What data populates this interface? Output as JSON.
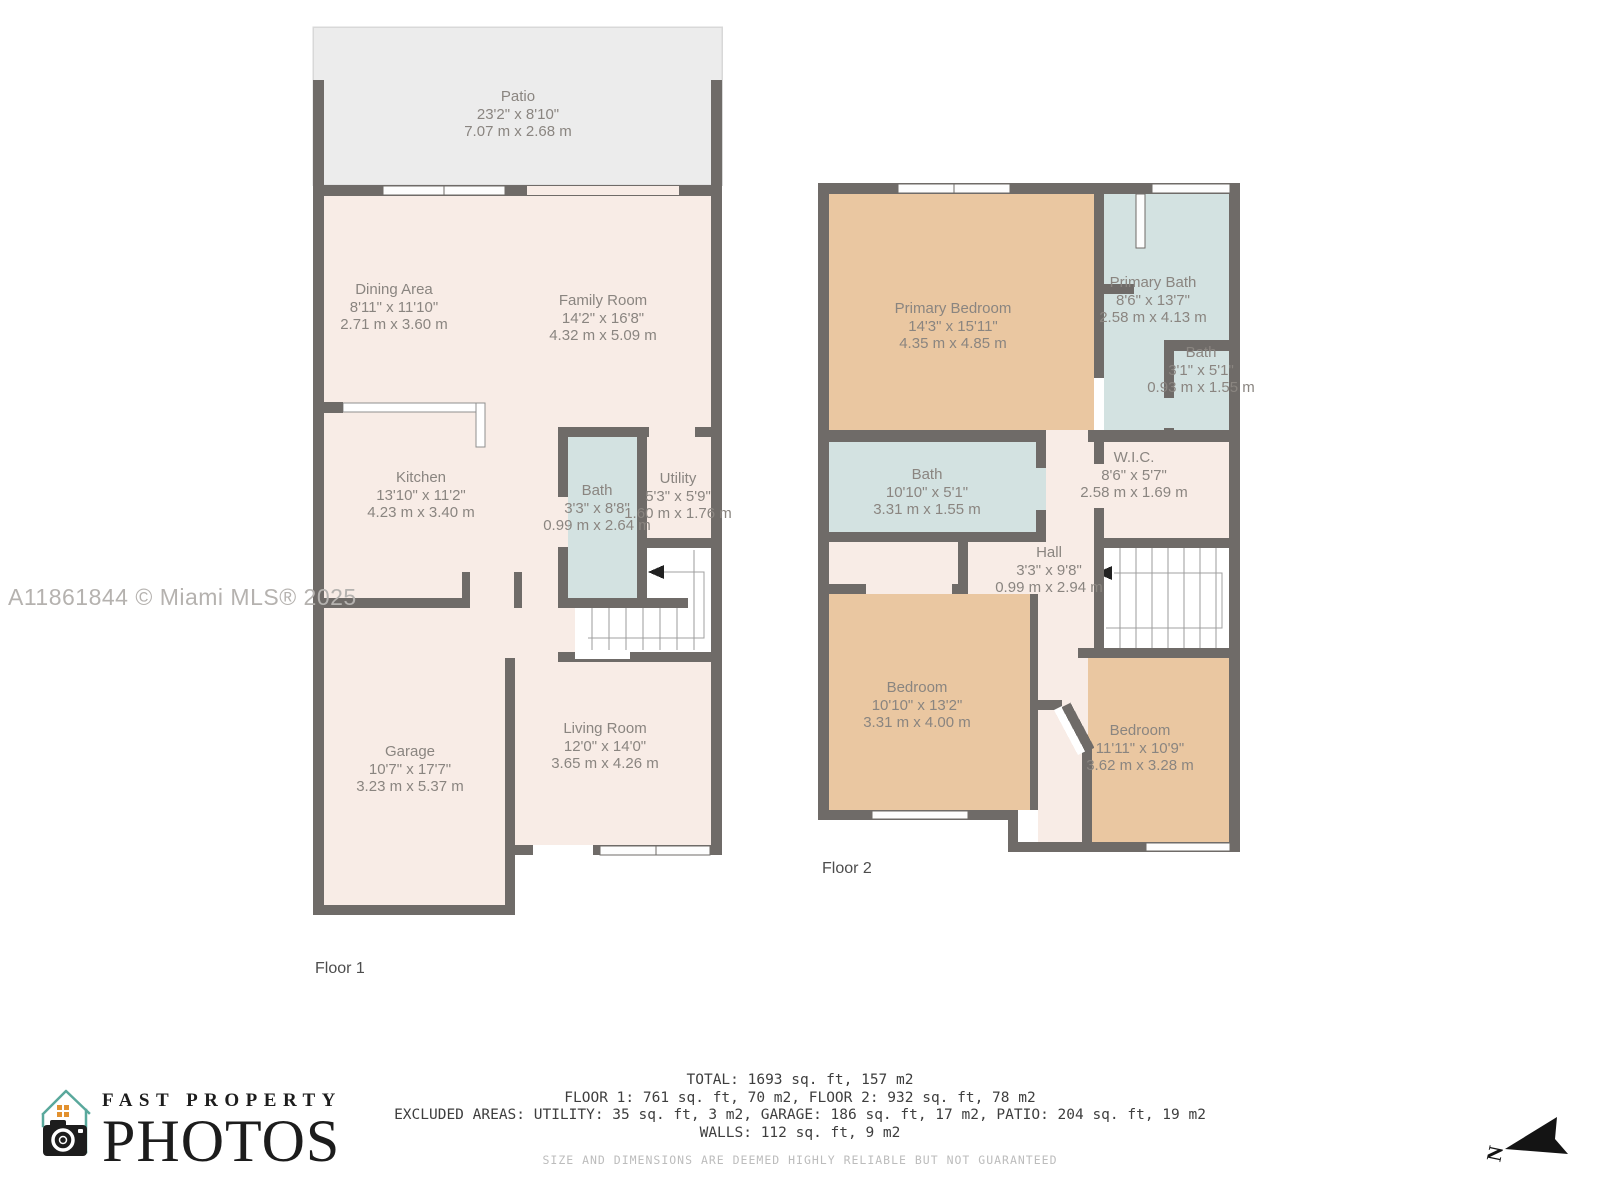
{
  "watermark": "A11861844 © Miami MLS® 2025",
  "palette": {
    "wall": "#6f6b68",
    "room_fill": "#f8ece6",
    "bedroom_fill": "#eac7a1",
    "bath_fill": "#d3e2e1",
    "patio_fill": "#ececec",
    "label_text": "#8a8580",
    "footer_text": "#3e3e3e",
    "logo_teal": "#59a89c",
    "logo_orange": "#e2912f"
  },
  "floor1": {
    "label": "Floor 1",
    "rooms": [
      {
        "name": "Patio",
        "imperial": "23'2\" x 8'10\"",
        "metric": "7.07 m x 2.68 m"
      },
      {
        "name": "Dining Area",
        "imperial": "8'11\" x 11'10\"",
        "metric": "2.71 m x 3.60 m"
      },
      {
        "name": "Family Room",
        "imperial": "14'2\" x 16'8\"",
        "metric": "4.32 m x 5.09 m"
      },
      {
        "name": "Kitchen",
        "imperial": "13'10\" x 11'2\"",
        "metric": "4.23 m x 3.40 m"
      },
      {
        "name": "Bath",
        "imperial": "3'3\" x 8'8\"",
        "metric": "0.99 m x 2.64 m"
      },
      {
        "name": "Utility",
        "imperial": "5'3\" x 5'9\"",
        "metric": "1.60 m x 1.76 m"
      },
      {
        "name": "Garage",
        "imperial": "10'7\" x 17'7\"",
        "metric": "3.23 m x 5.37 m"
      },
      {
        "name": "Living Room",
        "imperial": "12'0\" x 14'0\"",
        "metric": "3.65 m x 4.26 m"
      }
    ]
  },
  "floor2": {
    "label": "Floor 2",
    "rooms": [
      {
        "name": "Primary Bedroom",
        "imperial": "14'3\" x 15'11\"",
        "metric": "4.35 m x 4.85 m"
      },
      {
        "name": "Primary Bath",
        "imperial": "8'6\" x 13'7\"",
        "metric": "2.58 m x 4.13 m"
      },
      {
        "name": "Bath",
        "imperial": "3'1\" x 5'1\"",
        "metric": "0.93 m x 1.55 m"
      },
      {
        "name": "Bath",
        "imperial": "10'10\" x 5'1\"",
        "metric": "3.31 m x 1.55 m"
      },
      {
        "name": "W.I.C.",
        "imperial": "8'6\" x 5'7\"",
        "metric": "2.58 m x 1.69 m"
      },
      {
        "name": "Hall",
        "imperial": "3'3\" x 9'8\"",
        "metric": "0.99 m x 2.94 m"
      },
      {
        "name": "Bedroom",
        "imperial": "10'10\" x 13'2\"",
        "metric": "3.31 m x 4.00 m"
      },
      {
        "name": "Bedroom",
        "imperial": "11'11\" x 10'9\"",
        "metric": "3.62 m x 3.28 m"
      }
    ]
  },
  "footer": {
    "total": "TOTAL: 1693 sq. ft, 157 m2",
    "floors": "FLOOR 1: 761 sq. ft, 70 m2, FLOOR 2: 932 sq. ft, 78 m2",
    "excluded": "EXCLUDED AREAS: UTILITY: 35 sq. ft, 3 m2, GARAGE: 186 sq. ft, 17 m2, PATIO: 204 sq. ft, 19 m2",
    "walls": "WALLS: 112 sq. ft, 9 m2",
    "disclaimer": "SIZE AND DIMENSIONS ARE DEEMED HIGHLY RELIABLE BUT NOT GUARANTEED"
  },
  "logo": {
    "line1": "FAST PROPERTY",
    "line2": "PHOTOS"
  },
  "compass": {
    "label": "N"
  }
}
